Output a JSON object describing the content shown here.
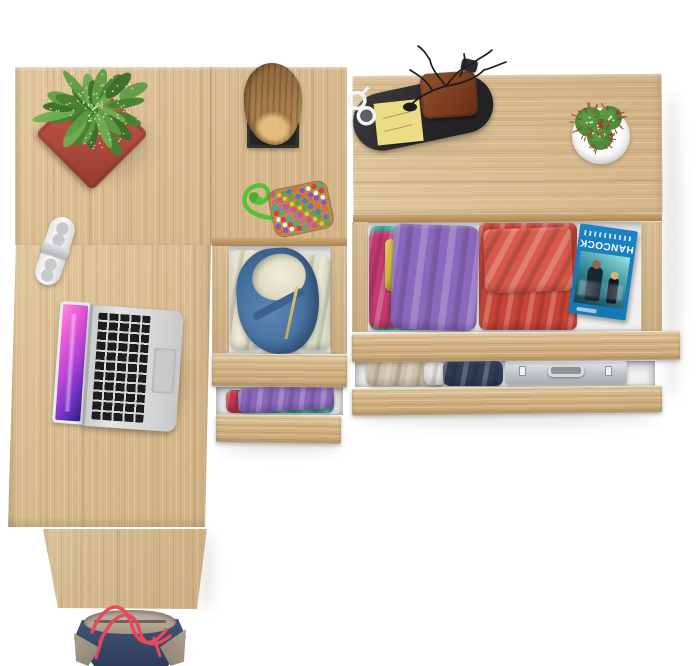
{
  "scene": {
    "view": "top-down product render",
    "background_color": "#ffffff",
    "furniture": {
      "desk": {
        "label": "oak-desk-left",
        "wood_color": "#d8bc90"
      },
      "under_desk_drawer_unit": {
        "label": "narrow-drawer-unit",
        "open_drawers": 2
      },
      "drawer_chest": {
        "label": "wide-drawer-chest",
        "open_drawers": 2
      },
      "interior_color": "#efefef",
      "drawer_front_color": "#d2b080"
    },
    "objects": [
      "spotted-green-plant-in-red-pot",
      "wood-log-decor-on-black-stand",
      "white-clip-gadget",
      "silver-laptop-pink-wallpaper",
      "beaded-pouch-with-green-rope",
      "black-valet-tray",
      "white-glasses",
      "yellow-sticky-notes",
      "brown-leather-wallet",
      "black-branch-sculpture",
      "key-fob",
      "cactus-in-white-pot",
      "folded-clothes-purple-teal-magenta",
      "folded-clothes-red",
      "hancock-bluray-case",
      "blue-hoodie-in-drawer",
      "folded-khaki-pants",
      "folded-navy-clothes",
      "aluminum-briefcase",
      "navy-tote-bag-red-handles"
    ]
  },
  "bluray": {
    "title": "HANCOCK",
    "case_color": "#1577b5",
    "title_color": "#ffffff"
  },
  "palettes": {
    "plant_greens": [
      "#5f9c44",
      "#47822f",
      "#6fae52",
      "#3c6f28"
    ],
    "pouch_dots": [
      "#d94f9e",
      "#e3c436",
      "#4fae4f",
      "#3f7fd9",
      "#e8712f",
      "#8f4fd9",
      "#f2f2f2",
      "#d93f3f",
      "#35b8a8",
      "#c36caf"
    ],
    "pouch_base": "#b98a4a",
    "rope_green": "#55c238",
    "cactus_body": "#4e8c3c",
    "cactus_spines": "#a23a2c",
    "handle_red": "#e8485e"
  }
}
